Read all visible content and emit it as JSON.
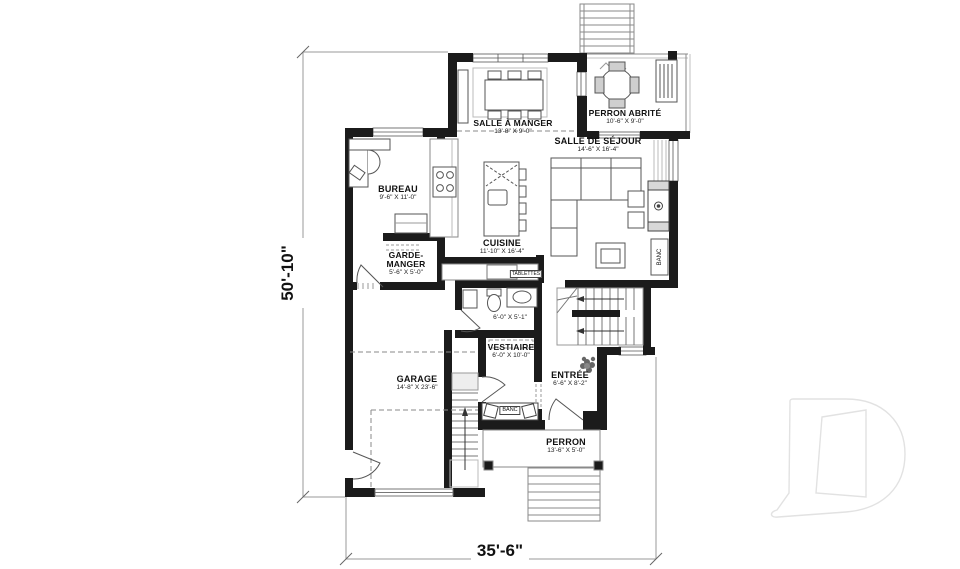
{
  "dimensions": {
    "overall_height": "50'-10\"",
    "overall_width": "35'-6\""
  },
  "rooms": {
    "salle_a_manger": {
      "name": "SALLE À MANGER",
      "dims": "13'-8\" X 9'-0\""
    },
    "perron_abrite": {
      "name": "PERRON ABRITÉ",
      "dims": "10'-6\" X 9'-0\""
    },
    "salle_de_sejour": {
      "name": "SALLE DE SÉJOUR",
      "dims": "14'-6\" X 16'-4\""
    },
    "bureau": {
      "name": "BUREAU",
      "dims": "9'-6\" X 11'-0\""
    },
    "cuisine": {
      "name": "CUISINE",
      "dims": "11'-10\" X 16'-4\""
    },
    "garde_manger": {
      "name_line1": "GARDE-",
      "name_line2": "MANGER",
      "dims": "5'-6\" X 5'-0\""
    },
    "salle_eau": {
      "dims": "6'-0\" X 5'-1\""
    },
    "vestiaire": {
      "name": "VESTIAIRE",
      "dims": "6'-0\" X 10'-0\""
    },
    "entree": {
      "name": "ENTRÉE",
      "dims": "6'-6\" X 8'-2\""
    },
    "garage": {
      "name": "GARAGE",
      "dims": "14'-8\" X 23'-6\""
    },
    "perron": {
      "name": "PERRON",
      "dims": "13'-6\" X 5'-0\""
    }
  },
  "annotations": {
    "banc_entree": "BANC",
    "banc_sejour": "BANC",
    "tablettes": "TABLETTES",
    "logo_icon": "d-letter-watermark"
  },
  "colors": {
    "wall": "#1b1b1b",
    "line": "#555555",
    "light_line": "#a0a0a0",
    "dim_line": "#9a9a9a",
    "logo_outline": "#e2e2e2"
  }
}
